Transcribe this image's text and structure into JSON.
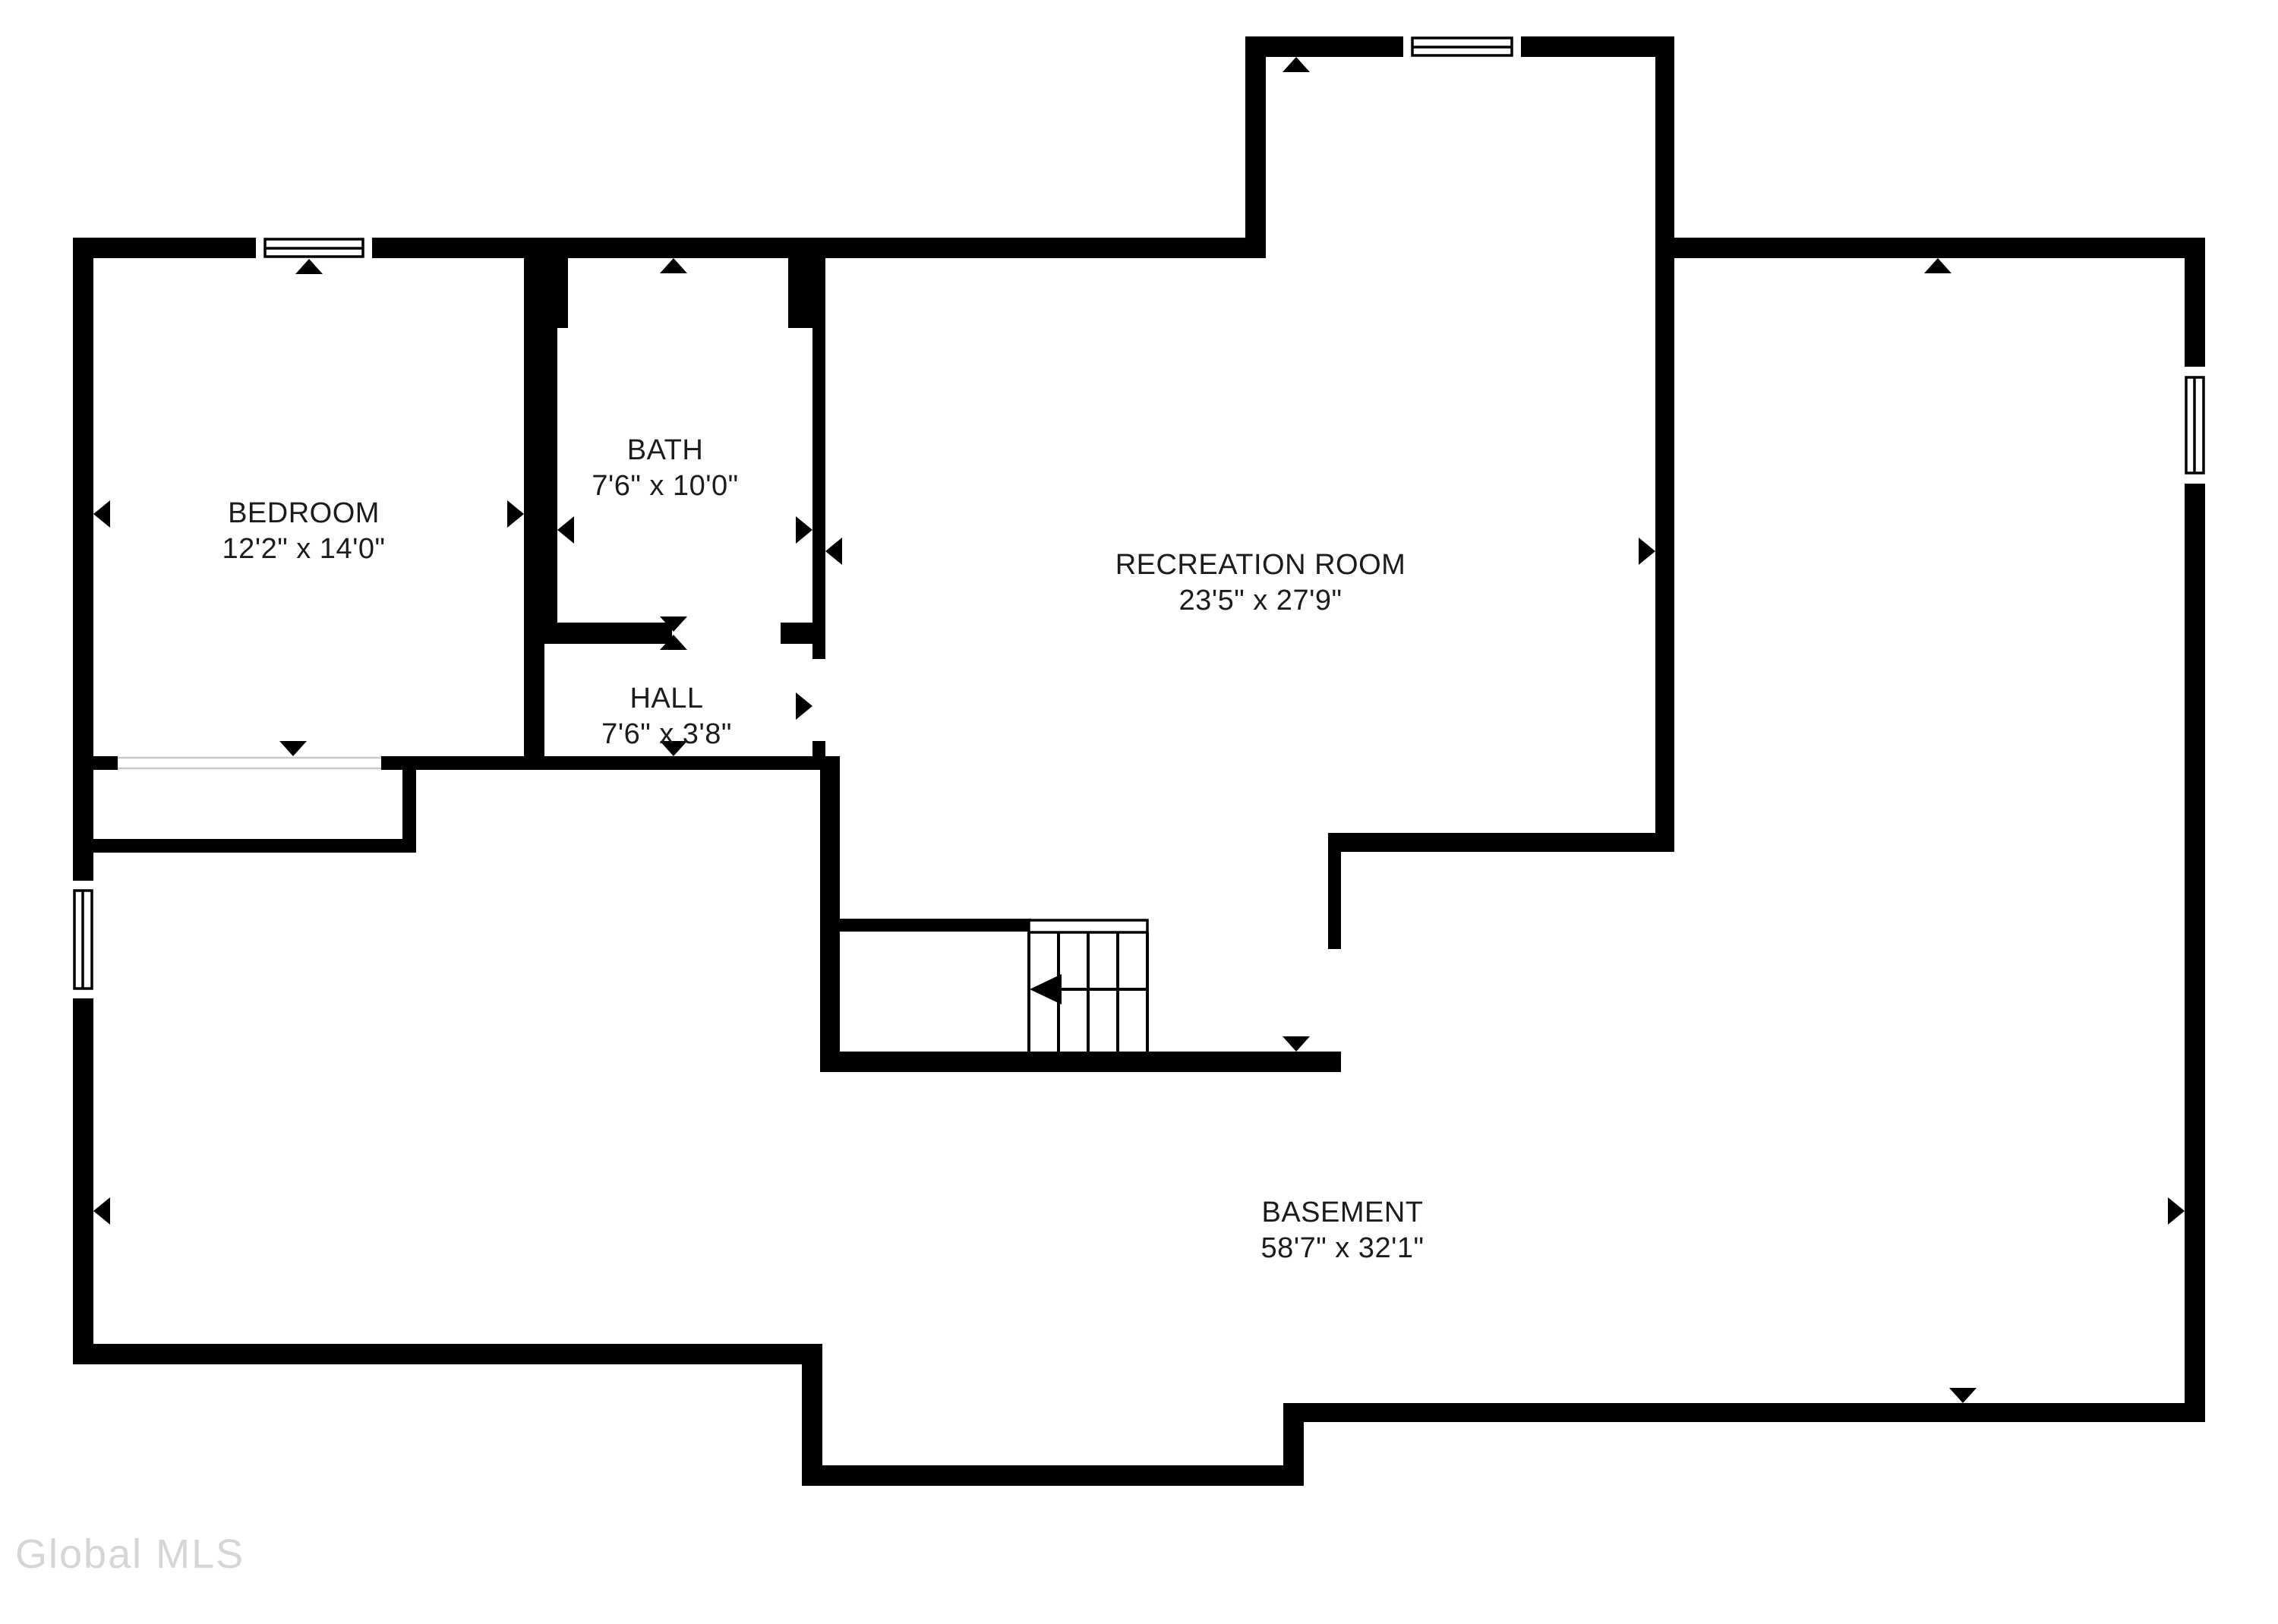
{
  "page": {
    "background": "#ffffff",
    "wall_color": "#000000",
    "label_color": "#1c1c1c",
    "opening_line_color": "#c9c9c9"
  },
  "watermark": {
    "text": "Global MLS",
    "color": "#d6d6d6"
  },
  "rooms": [
    {
      "id": "bedroom",
      "name": "BEDROOM",
      "dimensions": "12'2\" x 14'0\""
    },
    {
      "id": "bath",
      "name": "BATH",
      "dimensions": "7'6\" x 10'0\""
    },
    {
      "id": "hall",
      "name": "HALL",
      "dimensions": "7'6\" x 3'8\""
    },
    {
      "id": "recreation-room",
      "name": "RECREATION ROOM",
      "dimensions": "23'5\" x 27'9\""
    },
    {
      "id": "basement",
      "name": "BASEMENT",
      "dimensions": "58'7\" x 32'1\""
    }
  ],
  "symbols": {
    "windows": [
      "bedroom-top-window",
      "recreation-room-top-window",
      "right-wall-window",
      "left-wall-window"
    ],
    "stairs": "stairs-down-symbol",
    "markers": "opening-marker-arrows"
  }
}
